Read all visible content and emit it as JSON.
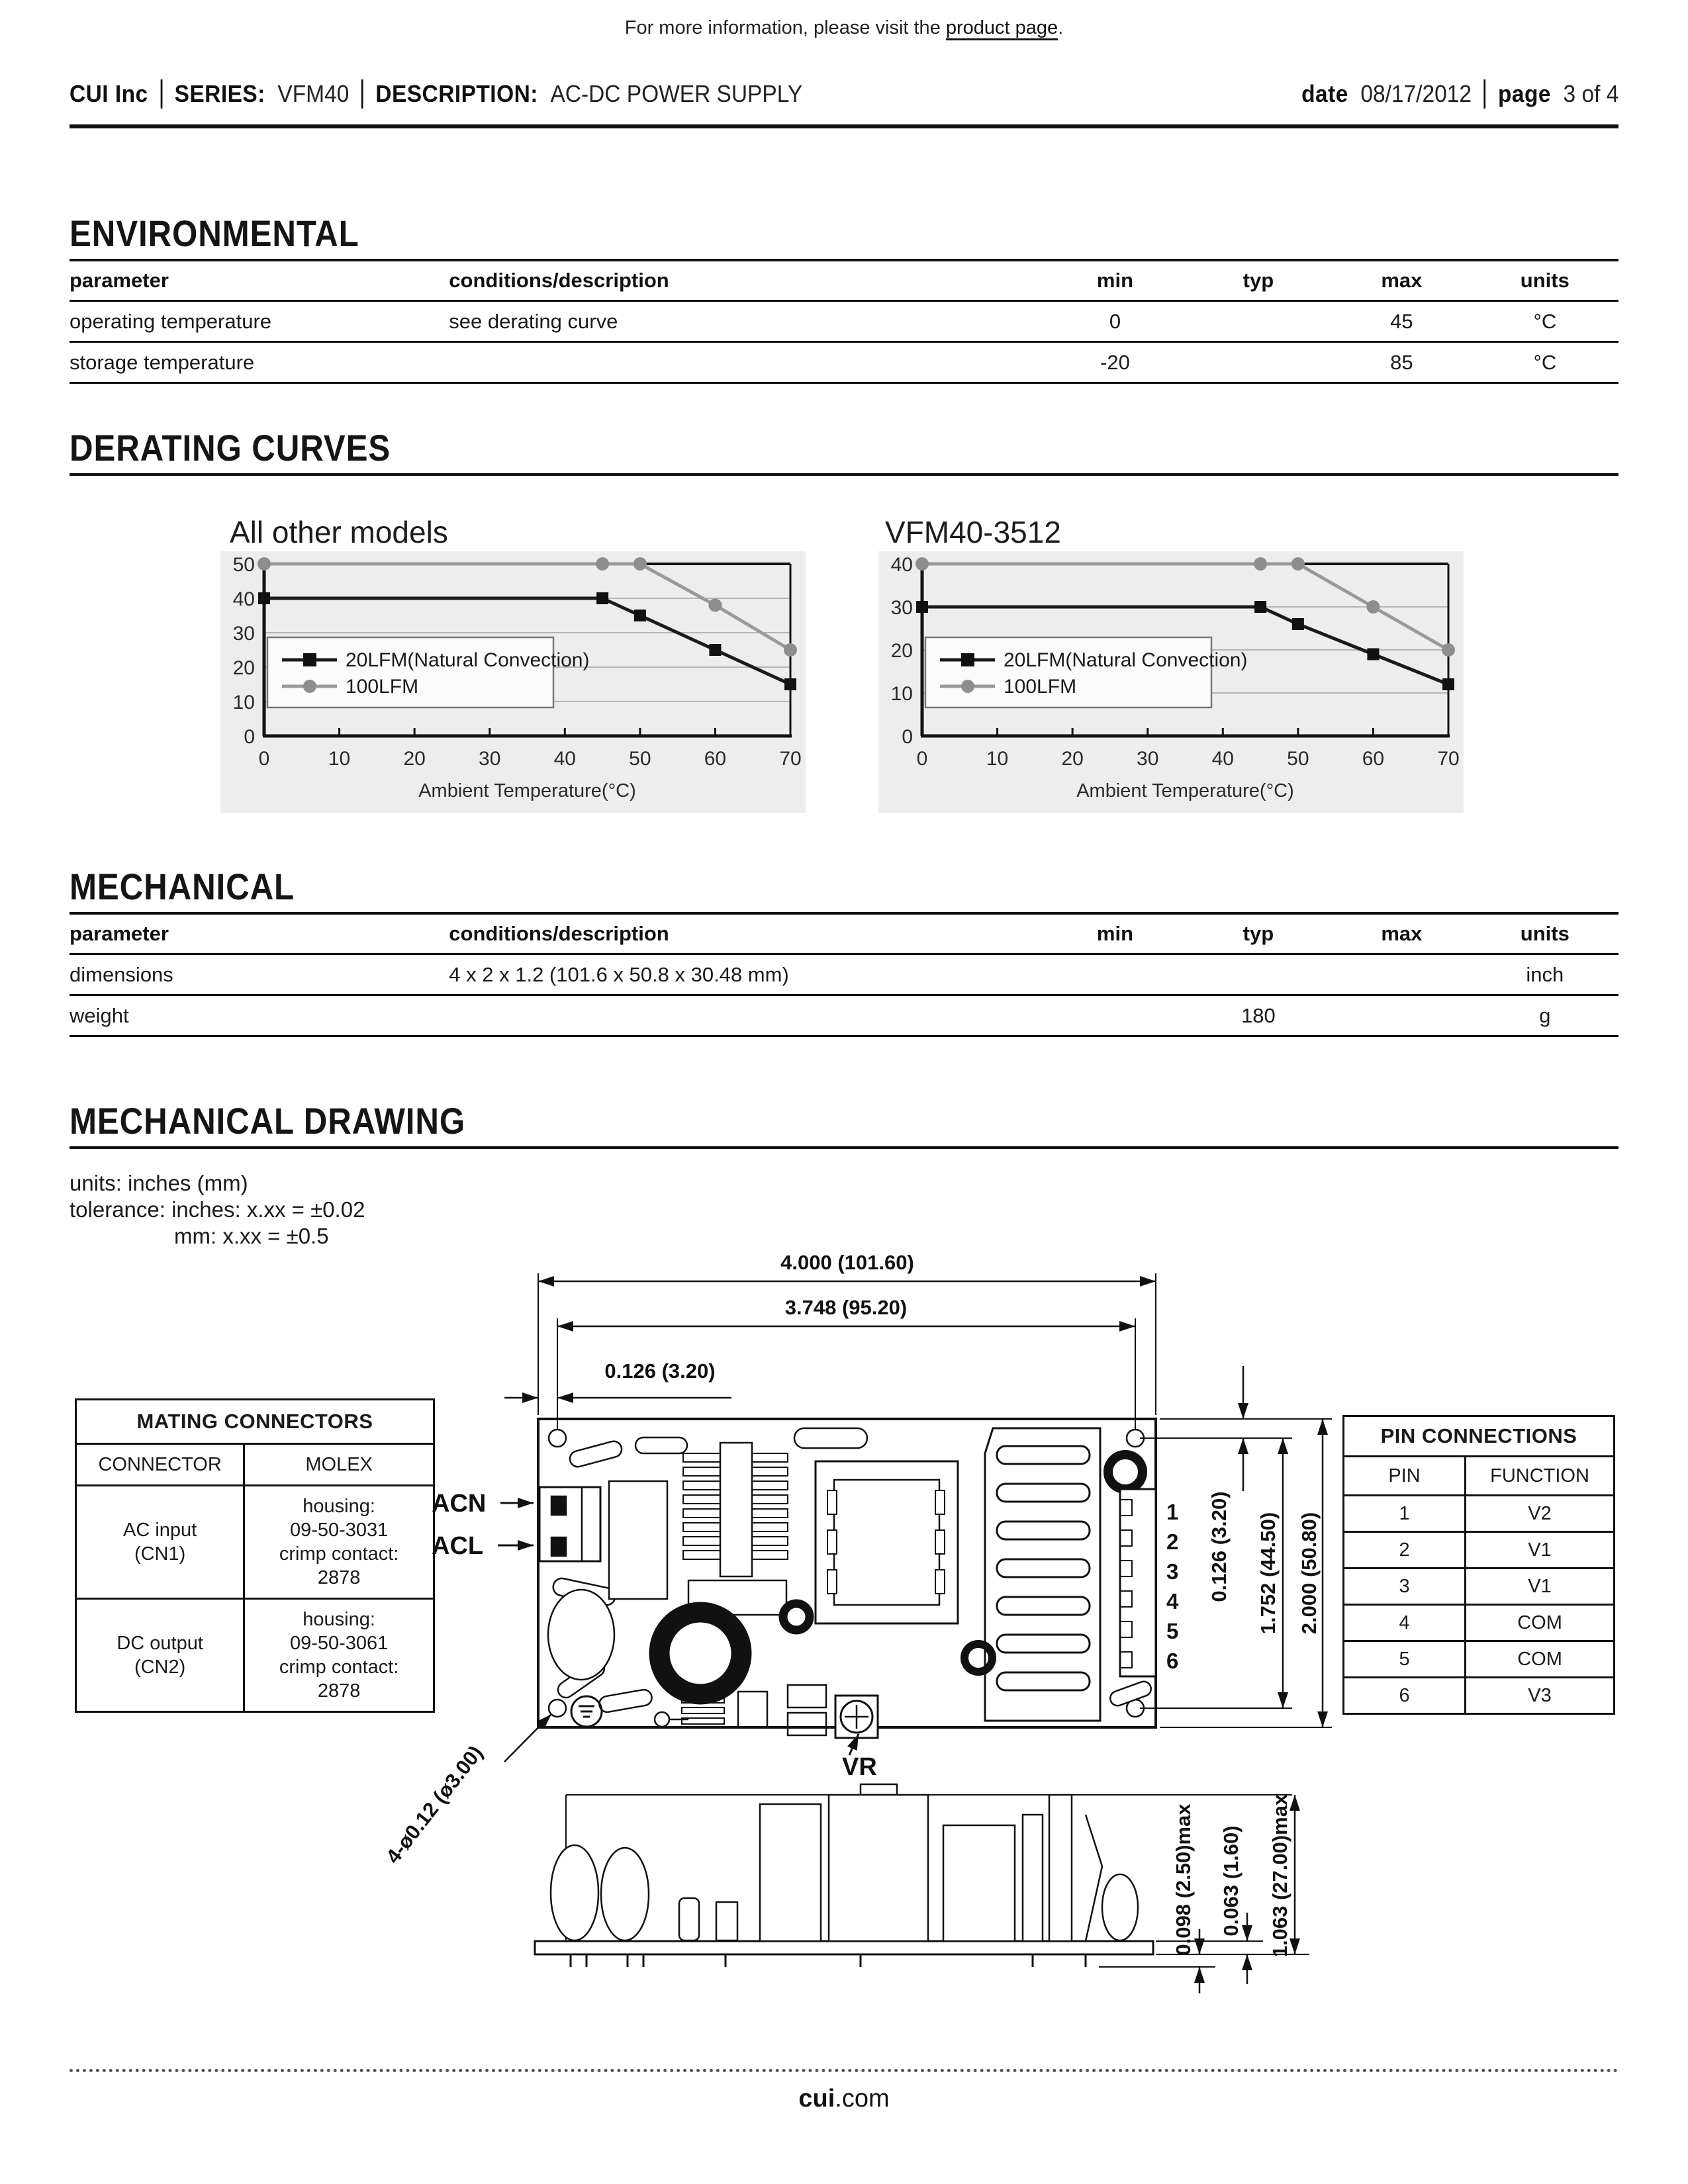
{
  "page": {
    "note_prefix": "For more information, please visit the ",
    "note_link": "product page",
    "note_suffix": ".",
    "footer_bold": "cui",
    "footer_rest": ".com"
  },
  "header": {
    "company": "CUI Inc",
    "series_label": "SERIES:",
    "series_value": "VFM40",
    "description_label": "DESCRIPTION:",
    "description_value": "AC-DC POWER SUPPLY",
    "date_label": "date",
    "date_value": "08/17/2012",
    "page_label": "page",
    "page_value": "3 of 4"
  },
  "environmental": {
    "title": "ENVIRONMENTAL",
    "columns": [
      "parameter",
      "conditions/description",
      "min",
      "typ",
      "max",
      "units"
    ],
    "rows": [
      [
        "operating temperature",
        "see derating curve",
        "0",
        "",
        "45",
        "°C"
      ],
      [
        "storage temperature",
        "",
        "-20",
        "",
        "85",
        "°C"
      ]
    ]
  },
  "derating": {
    "title": "DERATING CURVES"
  },
  "mechanical": {
    "title": "MECHANICAL",
    "columns": [
      "parameter",
      "conditions/description",
      "min",
      "typ",
      "max",
      "units"
    ],
    "rows": [
      [
        "dimensions",
        "4 x 2 x 1.2 (101.6 x 50.8 x 30.48 mm)",
        "",
        "",
        "",
        "inch"
      ],
      [
        "weight",
        "",
        "",
        "180",
        "",
        "g"
      ]
    ]
  },
  "mechanical_drawing": {
    "title": "MECHANICAL DRAWING",
    "units_note": "units: inches (mm)",
    "tolerance_note_1": "tolerance: inches: x.xx = ±0.02",
    "tolerance_note_2": "mm: x.xx = ±0.5",
    "labels": {
      "acn": "ACN",
      "acl": "ACL",
      "vr": "VR",
      "hole_callout": "4-ø0.12 (ø3.00)",
      "pins": [
        "1",
        "2",
        "3",
        "4",
        "5",
        "6"
      ]
    },
    "dimensions": {
      "width_outer": "4.000 (101.60)",
      "width_inner": "3.748 (95.20)",
      "offset_left": "0.126 (3.20)",
      "offset_top": "0.126 (3.20)",
      "height_inner": "1.752 (44.50)",
      "height_outer": "2.000 (50.80)",
      "pin_protrusion": "0.098 (2.50)max",
      "pcb_thickness": "0.063 (1.60)",
      "component_height": "1.063 (27.00)max"
    },
    "mating_connectors": {
      "title": "MATING CONNECTORS",
      "columns": [
        "CONNECTOR",
        "MOLEX"
      ],
      "rows": [
        {
          "connector": [
            "AC input",
            "(CN1)"
          ],
          "molex": [
            "housing:",
            "09-50-3031",
            "crimp contact:",
            "2878"
          ]
        },
        {
          "connector": [
            "DC output",
            "(CN2)"
          ],
          "molex": [
            "housing:",
            "09-50-3061",
            "crimp contact:",
            "2878"
          ]
        }
      ]
    },
    "pin_connections": {
      "title": "PIN CONNECTIONS",
      "columns": [
        "PIN",
        "FUNCTION"
      ],
      "rows": [
        [
          "1",
          "V2"
        ],
        [
          "2",
          "V1"
        ],
        [
          "3",
          "V1"
        ],
        [
          "4",
          "COM"
        ],
        [
          "5",
          "COM"
        ],
        [
          "6",
          "V3"
        ]
      ]
    }
  },
  "chart_data": [
    {
      "type": "line",
      "title": "All other models",
      "xlabel": "Ambient Temperature(°C)",
      "ylabel": "",
      "xlim": [
        0,
        70
      ],
      "ylim": [
        0,
        50
      ],
      "x_ticks": [
        0,
        10,
        20,
        30,
        40,
        50,
        60,
        70
      ],
      "y_ticks": [
        0,
        10,
        20,
        30,
        40,
        50
      ],
      "grid": true,
      "legend_position": "lower-left",
      "series": [
        {
          "name": "20LFM(Natural Convection)",
          "marker": "square",
          "color": "#1a1a1a",
          "points": [
            [
              0,
              40
            ],
            [
              45,
              40
            ],
            [
              50,
              35
            ],
            [
              60,
              25
            ],
            [
              70,
              15
            ]
          ]
        },
        {
          "name": "100LFM",
          "marker": "circle",
          "color": "#999999",
          "points": [
            [
              0,
              50
            ],
            [
              45,
              50
            ],
            [
              50,
              50
            ],
            [
              60,
              38
            ],
            [
              70,
              25
            ]
          ]
        }
      ]
    },
    {
      "type": "line",
      "title": "VFM40-3512",
      "xlabel": "Ambient Temperature(°C)",
      "ylabel": "",
      "xlim": [
        0,
        70
      ],
      "ylim": [
        0,
        40
      ],
      "x_ticks": [
        0,
        10,
        20,
        30,
        40,
        50,
        60,
        70
      ],
      "y_ticks": [
        0,
        10,
        20,
        30,
        40
      ],
      "grid": true,
      "legend_position": "lower-left",
      "series": [
        {
          "name": "20LFM(Natural Convection)",
          "marker": "square",
          "color": "#1a1a1a",
          "points": [
            [
              0,
              30
            ],
            [
              45,
              30
            ],
            [
              50,
              26
            ],
            [
              60,
              19
            ],
            [
              70,
              12
            ]
          ]
        },
        {
          "name": "100LFM",
          "marker": "circle",
          "color": "#999999",
          "points": [
            [
              0,
              40
            ],
            [
              45,
              40
            ],
            [
              50,
              40
            ],
            [
              60,
              30
            ],
            [
              70,
              20
            ]
          ]
        }
      ]
    }
  ]
}
